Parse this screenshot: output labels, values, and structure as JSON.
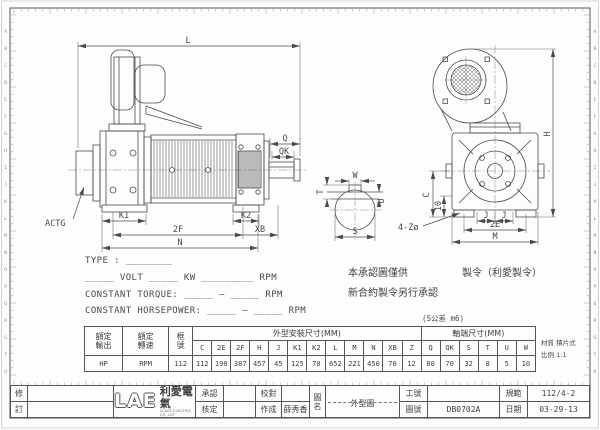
{
  "colors": {
    "line": "#4a4a4a",
    "centerline": "#8a8a8a",
    "paper": "#fdfdfc",
    "border": "#555555"
  },
  "frame": {
    "row_letters": [
      "A",
      "B",
      "C",
      "D",
      "E",
      "F",
      "G",
      "H",
      "I",
      "J",
      "K",
      "L",
      "M",
      "N",
      "O",
      "P",
      "Q",
      "R",
      "S",
      "T",
      "U"
    ]
  },
  "drawing": {
    "labels": {
      "l": "L",
      "q": "Q",
      "qk": "QK",
      "actg": "ACTG",
      "k1": "K1",
      "k2": "K2",
      "two_f": "2F",
      "xb": "XB",
      "n": "N",
      "h": "H",
      "c": "C",
      "ten": "10",
      "holes": "4-Zø",
      "j_left": "J",
      "j_right": "J",
      "two_e": "2E",
      "m": "M",
      "w": "W",
      "t": "T",
      "u": "U",
      "s": "S"
    }
  },
  "specs": {
    "type_line": "TYPE : ________",
    "power_line": "_____ VOLT _____ KW _________ RPM",
    "torque_line": "CONSTANT TORQUE: _____ — _____ RPM",
    "horsepower_line": "CONSTANT HORSEPOWER: _____ — _____ RPM"
  },
  "notes": {
    "note1": "本承認圖僅供",
    "note2": "新合約製令另行承認",
    "note3": "製令（利愛製令）",
    "tolerance": "(S公差 m6)",
    "material": "材質 積片式",
    "scale": "比例 1:1"
  },
  "table": {
    "rated_output_label": "額定\n輸出",
    "rated_output_unit": "HP",
    "rated_speed_label": "額定\n轉速",
    "rated_speed_unit": "RPM",
    "frame_label": "框\n號",
    "frame_value": "112",
    "outline_group_label": "外型安裝尺寸(MM)",
    "shaft_group_label": "軸端尺寸(MM)",
    "outline_cols": [
      "C",
      "2E",
      "2F",
      "H",
      "J",
      "K1",
      "K2",
      "L",
      "M",
      "N",
      "XB",
      "Z"
    ],
    "outline_values": [
      "112",
      "190",
      "387",
      "457",
      "45",
      "125",
      "70",
      "652",
      "221",
      "450",
      "70",
      "12"
    ],
    "shaft_cols": [
      "Q",
      "QK",
      "S",
      "T",
      "U",
      "W"
    ],
    "shaft_values": [
      "80",
      "70",
      "32",
      "8",
      "5",
      "10"
    ]
  },
  "titleblock": {
    "rev_top": "修",
    "rev_bottom": "訂",
    "logo_text": "LAE",
    "logo_cn": "利愛電氣",
    "logo_sub": "LI AVE ELECTRIC CO.,LDT",
    "approve_label": "承認",
    "check_label": "核定",
    "proof_label": "校對",
    "made_label": "作成",
    "made_value": "薛秀香",
    "drawing_name_label": "圖名",
    "drawing_name_value": "外型圖",
    "work_no_label": "工號",
    "work_no_value": "",
    "drawing_no_label": "圖號",
    "drawing_no_value": "DB0702A",
    "spec_label": "規範",
    "spec_value": "112/4-2",
    "date_label": "日期",
    "date_value": "03-29-13"
  }
}
